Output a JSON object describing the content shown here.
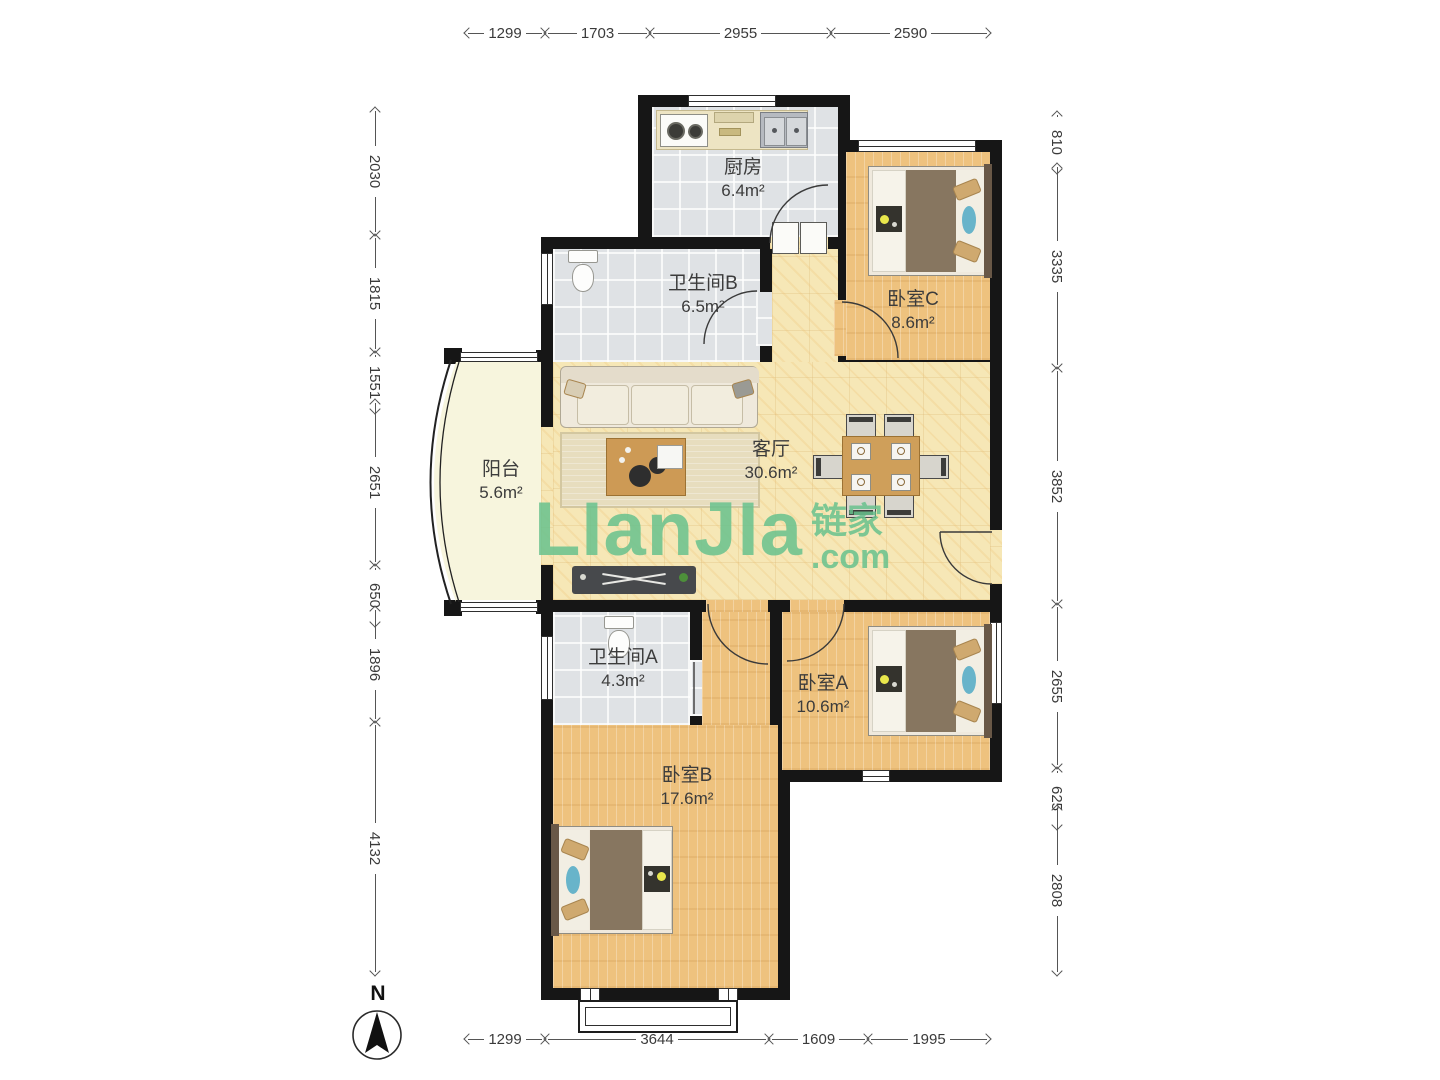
{
  "watermark": {
    "brand": "LIanJIa",
    "cjk": "链家",
    "tld": ".com"
  },
  "compass": {
    "label": "N"
  },
  "rooms": [
    {
      "name": "厨房",
      "area": "6.4m²"
    },
    {
      "name": "卫生间B",
      "area": "6.5m²"
    },
    {
      "name": "卧室C",
      "area": "8.6m²"
    },
    {
      "name": "客厅",
      "area": "30.6m²"
    },
    {
      "name": "阳台",
      "area": "5.6m²"
    },
    {
      "name": "卫生间A",
      "area": "4.3m²"
    },
    {
      "name": "卧室A",
      "area": "10.6m²"
    },
    {
      "name": "卧室B",
      "area": "17.6m²"
    }
  ],
  "dims": {
    "top": [
      "1299",
      "1703",
      "2955",
      "2590"
    ],
    "bottom": [
      "1299",
      "3644",
      "1609",
      "1995"
    ],
    "left": [
      "2030",
      "1815",
      "1551",
      "2651",
      "650",
      "1896",
      "4132"
    ],
    "right": [
      "810",
      "3335",
      "3852",
      "2655",
      "625",
      "2808"
    ]
  }
}
